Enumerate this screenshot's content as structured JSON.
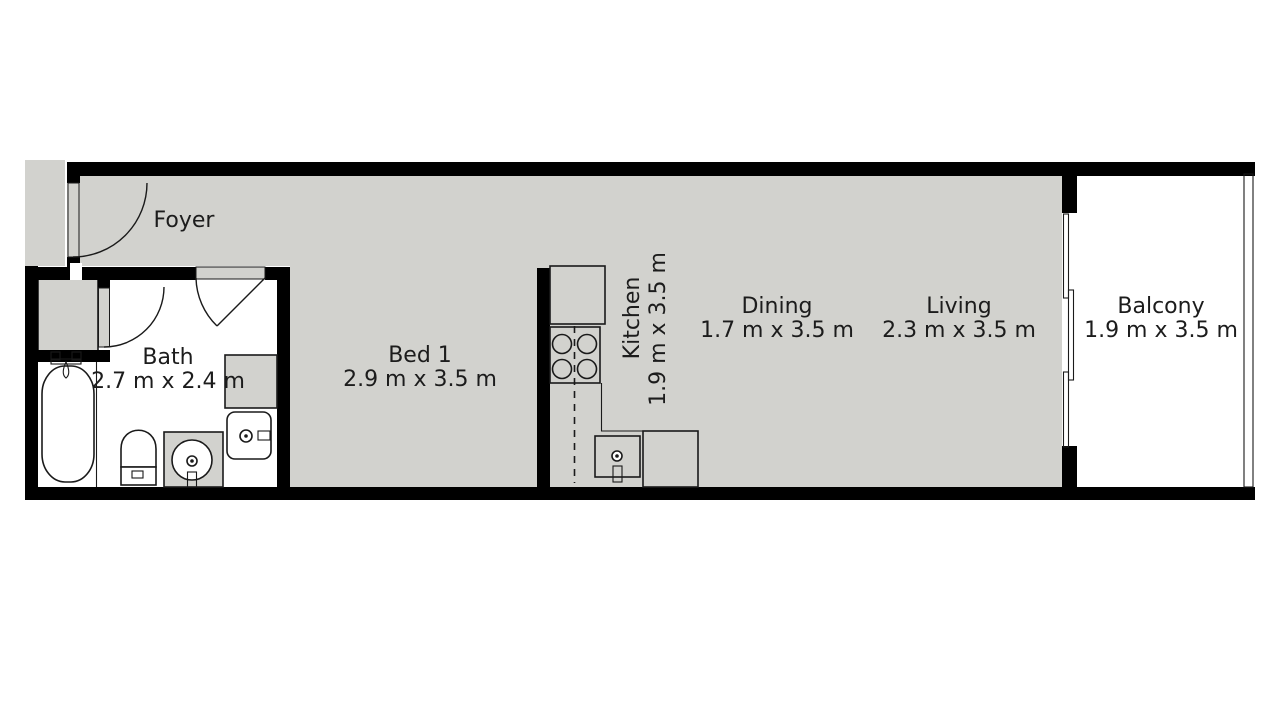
{
  "floorplan": {
    "type": "apartment-floor-plan",
    "colors": {
      "floor": "#d2d2ce",
      "wall": "#000000",
      "room_interior": "#ffffff",
      "outline": "#1a1a1a",
      "text": "#1c1c1c"
    },
    "rooms": [
      {
        "id": "foyer",
        "name": "Foyer",
        "dims": ""
      },
      {
        "id": "bath",
        "name": "Bath",
        "dims": "2.7 m x 2.4 m"
      },
      {
        "id": "bed-1",
        "name": "Bed 1",
        "dims": "2.9 m x 3.5 m"
      },
      {
        "id": "kitchen",
        "name": "Kitchen",
        "dims": "1.9 m x 3.5 m",
        "label_rotation_deg": -90
      },
      {
        "id": "dining",
        "name": "Dining",
        "dims": "1.7 m x 3.5 m"
      },
      {
        "id": "living",
        "name": "Living",
        "dims": "2.3 m x 3.5 m"
      },
      {
        "id": "balcony",
        "name": "Balcony",
        "dims": "1.9 m x 3.5 m"
      }
    ],
    "fixtures": {
      "bath": [
        "bathtub",
        "toilet",
        "vanity-sink",
        "washing-machine",
        "cabinet",
        "closet"
      ],
      "kitchen": [
        "fridge",
        "stove",
        "kitchen-sink",
        "counter"
      ]
    },
    "features": [
      "entry-door",
      "bath-door",
      "closet-door",
      "balcony-sliding-door",
      "balcony-railing"
    ]
  }
}
